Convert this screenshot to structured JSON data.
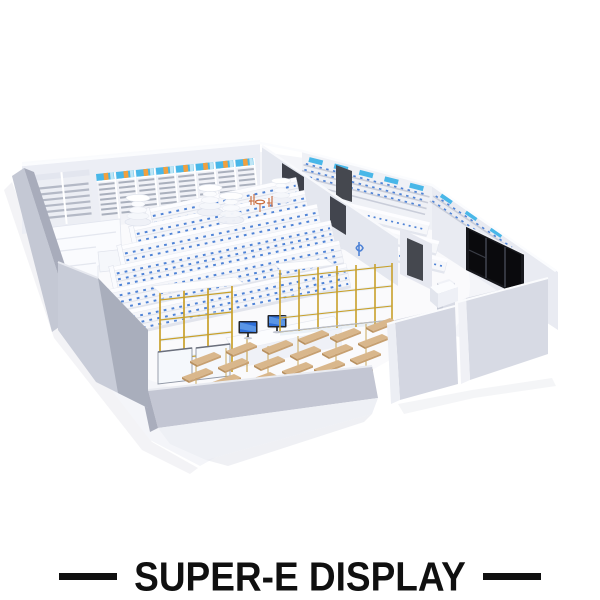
{
  "brand": {
    "name": "SUPER-E DISPLAY",
    "dash_count": 2
  },
  "scene": {
    "label": "isometric 3d render of a retail pharmacy store interior, roof removed",
    "colors": {
      "text_black": "#101010",
      "background": "#ffffff",
      "floor": "#f4f5f9",
      "wall_light": "#edeff5",
      "wall_gray": "#c3c6d3",
      "shelf_slat": "#aab0bd",
      "product_blue": "#4f83d6",
      "sign_cyan": "#49b7e8",
      "sign_orange": "#f0a03f",
      "gold_rack": "#c9a02b",
      "gold_leg": "#caa85a",
      "wood": "#d9b78c",
      "screen_blue": "#2f6fd8",
      "window_black": "#0a0a0d",
      "door_gray": "#45484f",
      "chair_orange": "#c96a3a"
    },
    "elements": [
      {
        "name": "wall-bays-with-lightbox-headers",
        "count": 8
      },
      {
        "name": "plain-wall-bays-left",
        "count": 2
      },
      {
        "name": "gondola-shelf-rows",
        "count": 6
      },
      {
        "name": "round-tier-towers",
        "count": 4
      },
      {
        "name": "gold-frame-glass-racks",
        "count": 3
      },
      {
        "name": "wood-tier-table-groups",
        "count": 3
      },
      {
        "name": "checkout-monitors",
        "count": 2
      },
      {
        "name": "island-gondolas-right-room",
        "count": 3
      },
      {
        "name": "dark-doors",
        "count": 2
      },
      {
        "name": "storefront-black-window",
        "count": 1
      },
      {
        "name": "orange-cafe-chairs",
        "count": 2
      }
    ]
  }
}
